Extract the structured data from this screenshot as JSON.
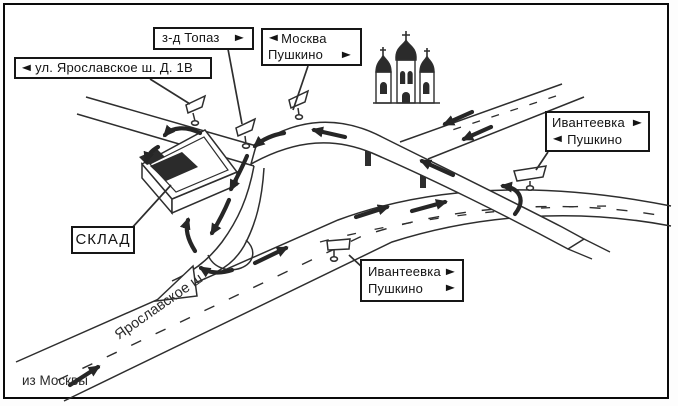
{
  "colors": {
    "ink": "#2e2e2e",
    "paper": "#ffffff",
    "frame": "#0a0a0a"
  },
  "signs": {
    "street": {
      "arrow": "◄",
      "text": "ул. Ярославское ш. Д. 1В"
    },
    "topaz": {
      "text": "з-д Топаз",
      "arrow": "►"
    },
    "moscow_pushkino": {
      "row1": {
        "arrow": "◄",
        "text": "Москва"
      },
      "row2": {
        "text": "Пушкино",
        "arrow": "►"
      }
    },
    "ivanteevka_right": {
      "row1": {
        "text": "Ивантеевка",
        "arrow": "►"
      },
      "row2": {
        "arrow": "◄",
        "text": "Пушкино"
      }
    },
    "ivanteevka_bottom": {
      "row1": {
        "text": "Ивантеевка",
        "arrow": "►"
      },
      "row2": {
        "text": "Пушкино",
        "arrow": "►"
      }
    },
    "sklad": {
      "text": "СКЛАД"
    }
  },
  "map_labels": {
    "road_name": "Ярославское ш.",
    "from_moscow": "из Москвы"
  }
}
